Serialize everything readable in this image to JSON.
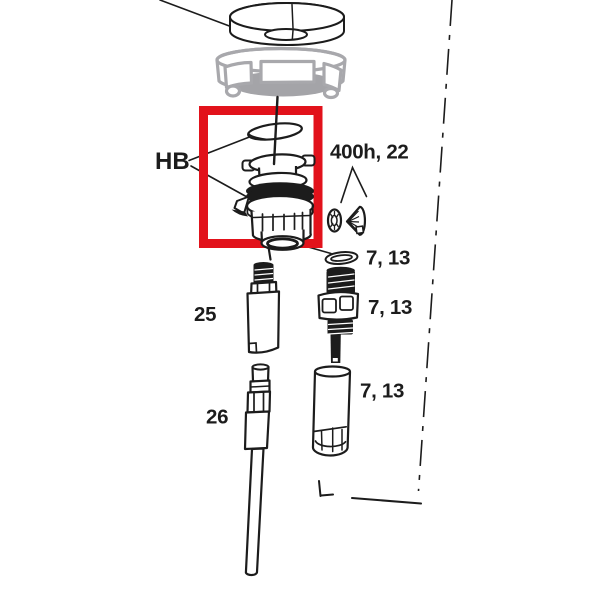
{
  "figure": {
    "highlight_color": "#e2121b",
    "ghost_color": "#a8a8ac",
    "ink_color": "#1c1c1c",
    "labels": {
      "hb": "HB",
      "group_400h": "400h, 22",
      "oring_top": "7, 13",
      "adjuster_screw": "7, 13",
      "damper_body": "7, 13",
      "part_25": "25",
      "part_26": "26"
    }
  }
}
